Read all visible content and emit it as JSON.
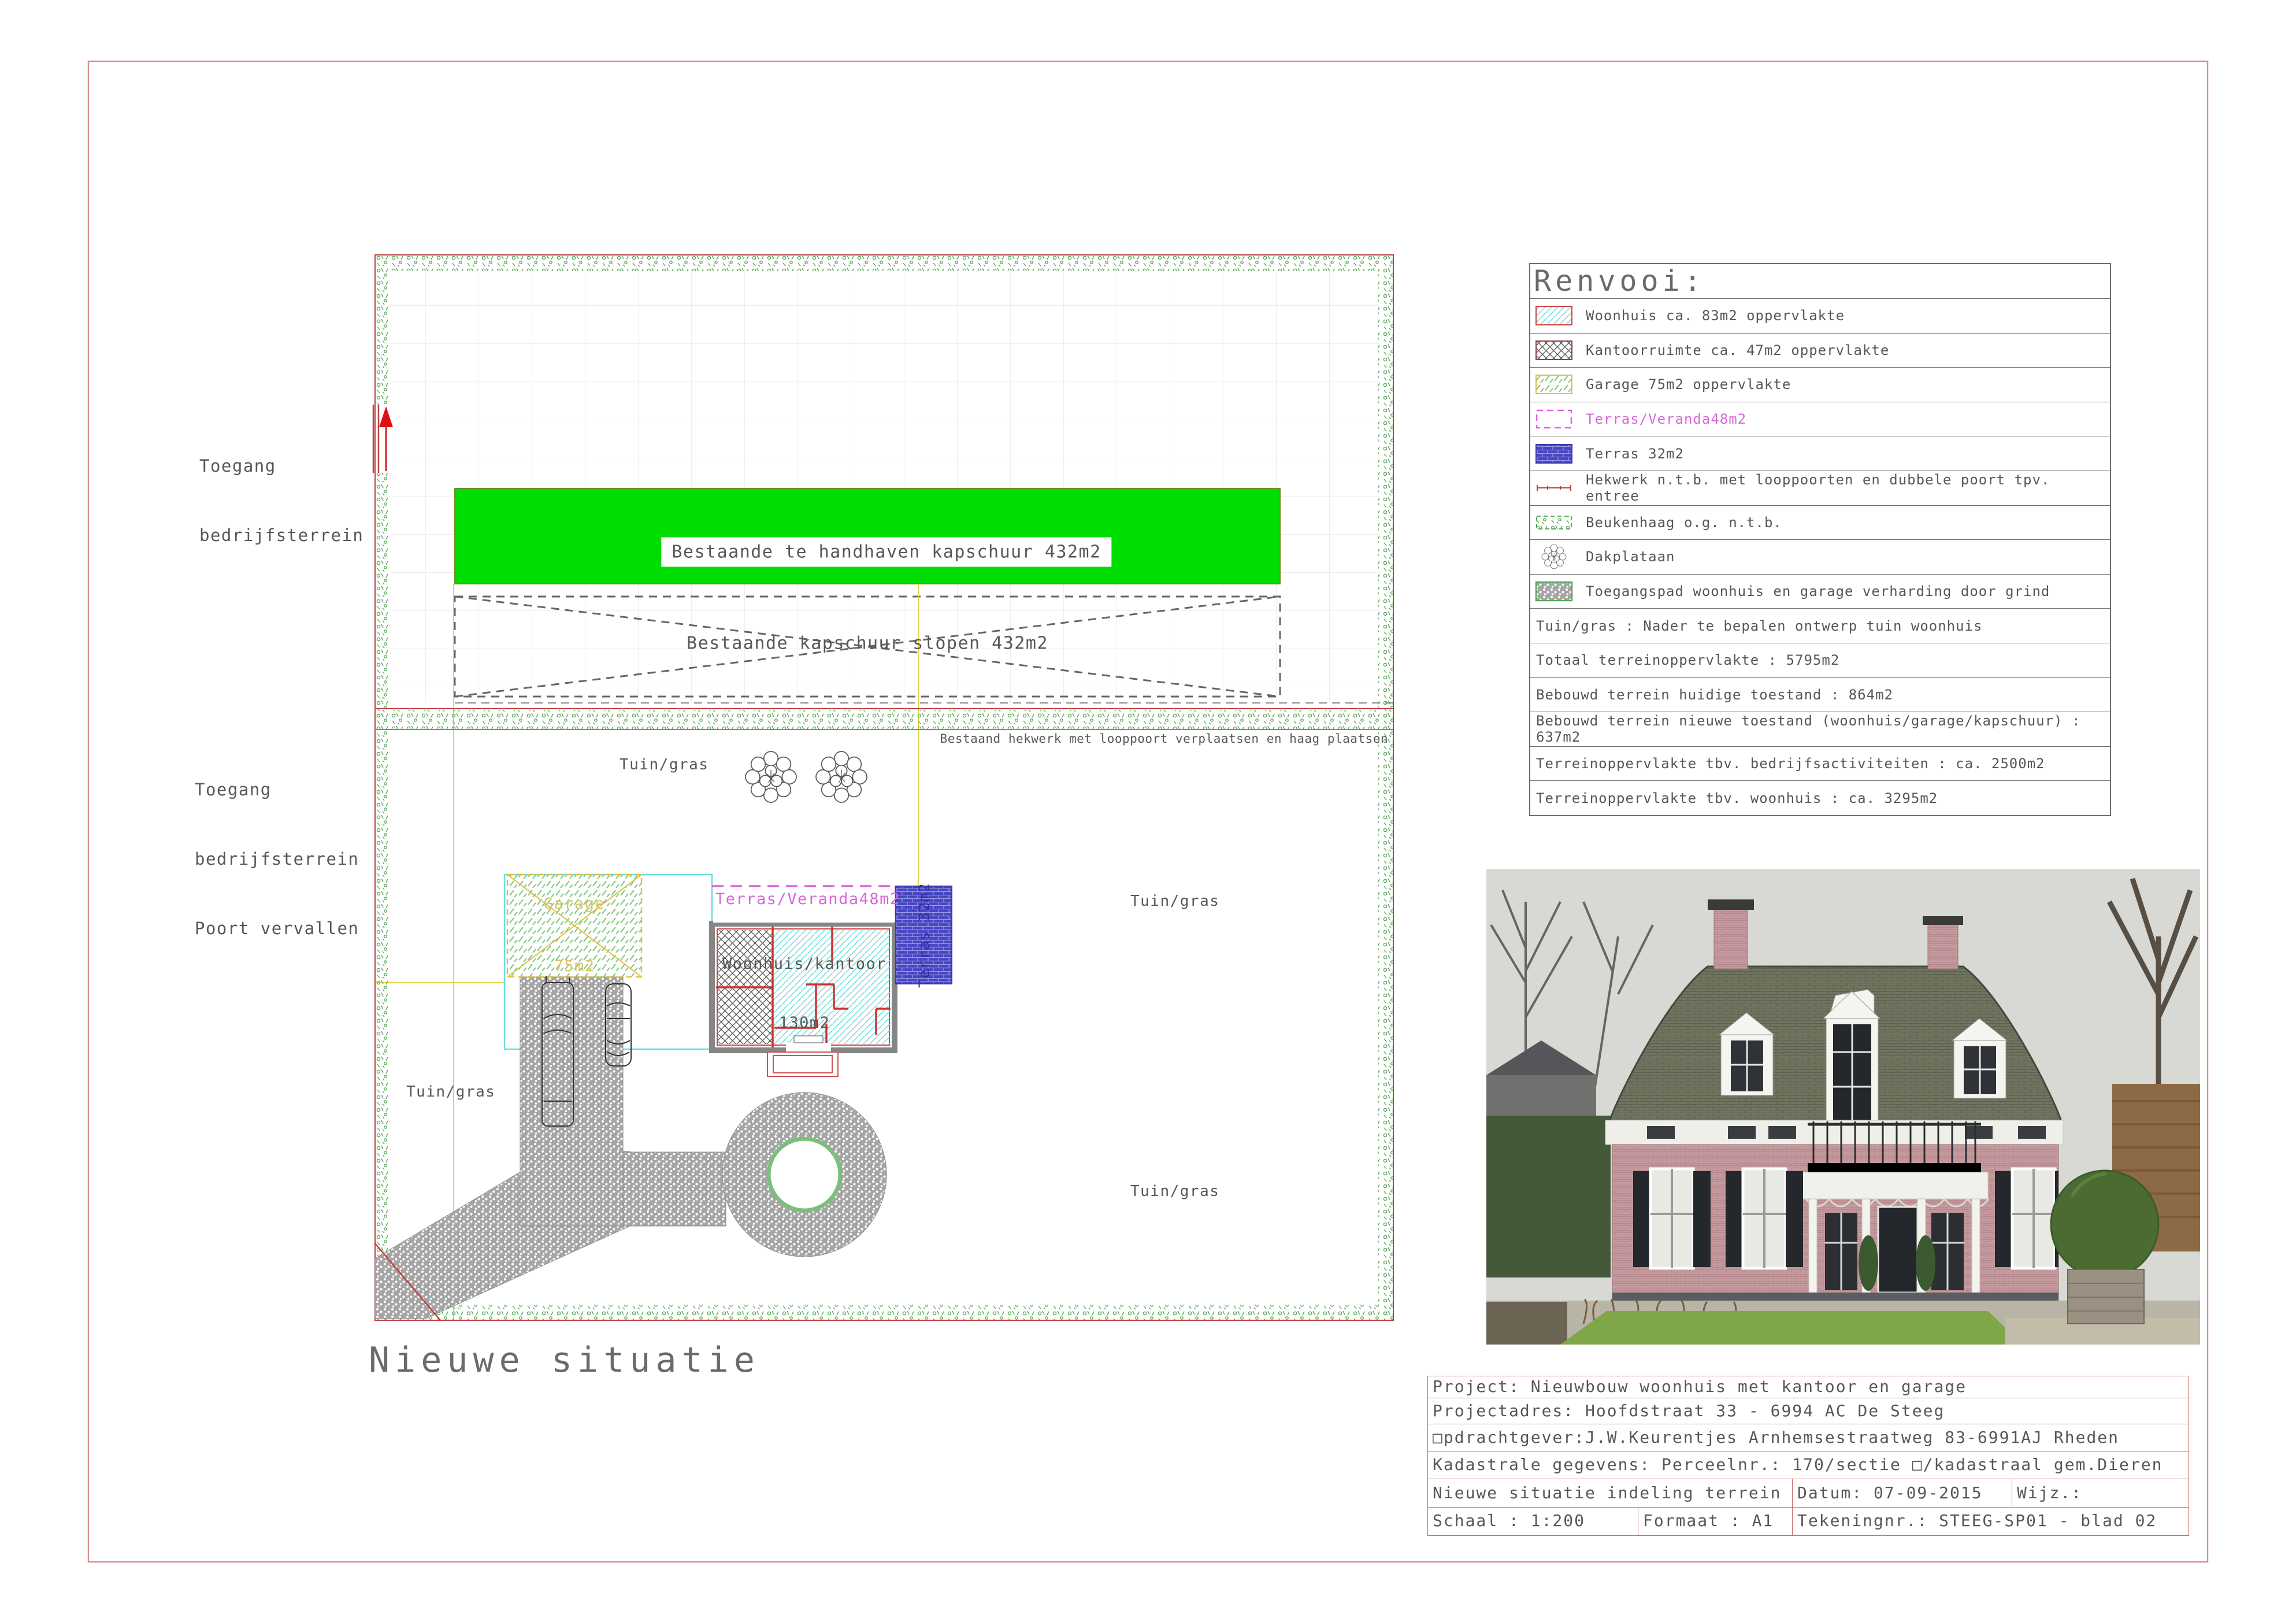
{
  "colors": {
    "sheet_border": "#d99090",
    "boundary_red": "#c04040",
    "hedge_green": "#5aa85a",
    "kapschuur_green": "#00dd00",
    "construction_yellow": "#e6d24a",
    "cyan_outline": "#6adede",
    "veranda_magenta": "#d966d9",
    "terras_blue": "#4646c4",
    "cad_text_gray": "#575757"
  },
  "plan": {
    "title": "Nieuwe situatie",
    "labels": {
      "access_top": [
        "Toegang",
        "bedrijfsterrein"
      ],
      "access_bottom": [
        "Toegang",
        "bedrijfsterrein",
        "Poort vervallen"
      ],
      "kapschuur_keep": "Bestaande te handhaven kapschuur 432m2",
      "kapschuur_demolish": "Bestaande kapschuur slopen 432m2",
      "fence_note": "Bestaand hekwerk met looppoort verplaatsen en haag plaatsen",
      "tuin_gras": "Tuin/gras",
      "garage": [
        "Garage",
        "75m2"
      ],
      "veranda": "Terras/Veranda48m2",
      "woonhuis": [
        "Woonhuis/kantoor",
        "130m2"
      ],
      "terras32": "Terras 32m2"
    }
  },
  "legend": {
    "title": "Renvooi:",
    "items": [
      {
        "icon": "woonhuis-hatch-swatch",
        "label": "Woonhuis ca. 83m2 oppervlakte"
      },
      {
        "icon": "kantoor-crosshatch-swatch",
        "label": "Kantoorruimte ca. 47m2 oppervlakte"
      },
      {
        "icon": "garage-hatch-swatch",
        "label": "Garage 75m2 oppervlakte"
      },
      {
        "icon": "veranda-dashed-swatch",
        "label": "Terras/Veranda48m2"
      },
      {
        "icon": "terras-solid-swatch",
        "label": "Terras 32m2"
      },
      {
        "icon": "hekwerk-line-swatch",
        "label": "Hekwerk n.t.b. met looppoorten en dubbele poort tpv. entree"
      },
      {
        "icon": "beukenhaag-swatch",
        "label": "Beukenhaag o.g. n.t.b."
      },
      {
        "icon": "dakplataan-tree-swatch",
        "label": "Dakplataan"
      },
      {
        "icon": "grind-gravel-swatch",
        "label": "Toegangspad woonhuis en garage verharding door grind"
      },
      {
        "icon": "none",
        "label": "Tuin/gras : Nader te bepalen ontwerp tuin woonhuis"
      },
      {
        "icon": "none",
        "label": "Totaal terreinoppervlakte : 5795m2"
      },
      {
        "icon": "none",
        "label": "Bebouwd terrein huidige toestand : 864m2"
      },
      {
        "icon": "none",
        "label": "Bebouwd terrein nieuwe toestand (woonhuis/garage/kapschuur) : 637m2"
      },
      {
        "icon": "none",
        "label": "Terreinoppervlakte tbv. bedrijfsactiviteiten : ca. 2500m2"
      },
      {
        "icon": "none",
        "label": "Terreinoppervlakte tbv. woonhuis : ca. 3295m2"
      }
    ]
  },
  "title_block": {
    "project": "Project: Nieuwbouw woonhuis met kantoor en garage",
    "address": "Projectadres: Hoofdstraat 33 - 6994 AC De Steeg",
    "client": "□pdrachtgever:J.W.Keurentjes Arnhemsestraatweg 83-6991AJ Rheden",
    "cadastral": "Kadastrale gegevens: Perceelnr.: 170/sectie □/kadastraal gem.Dieren",
    "drawing_name": "Nieuwe situatie indeling terrein",
    "date": "Datum: 07-09-2015",
    "revision": "Wijz.:",
    "scale": "Schaal : 1:200",
    "format": "Formaat : A1",
    "drawing_number": "Tekeningnr.: STEEG-SP01 - blad 02"
  }
}
